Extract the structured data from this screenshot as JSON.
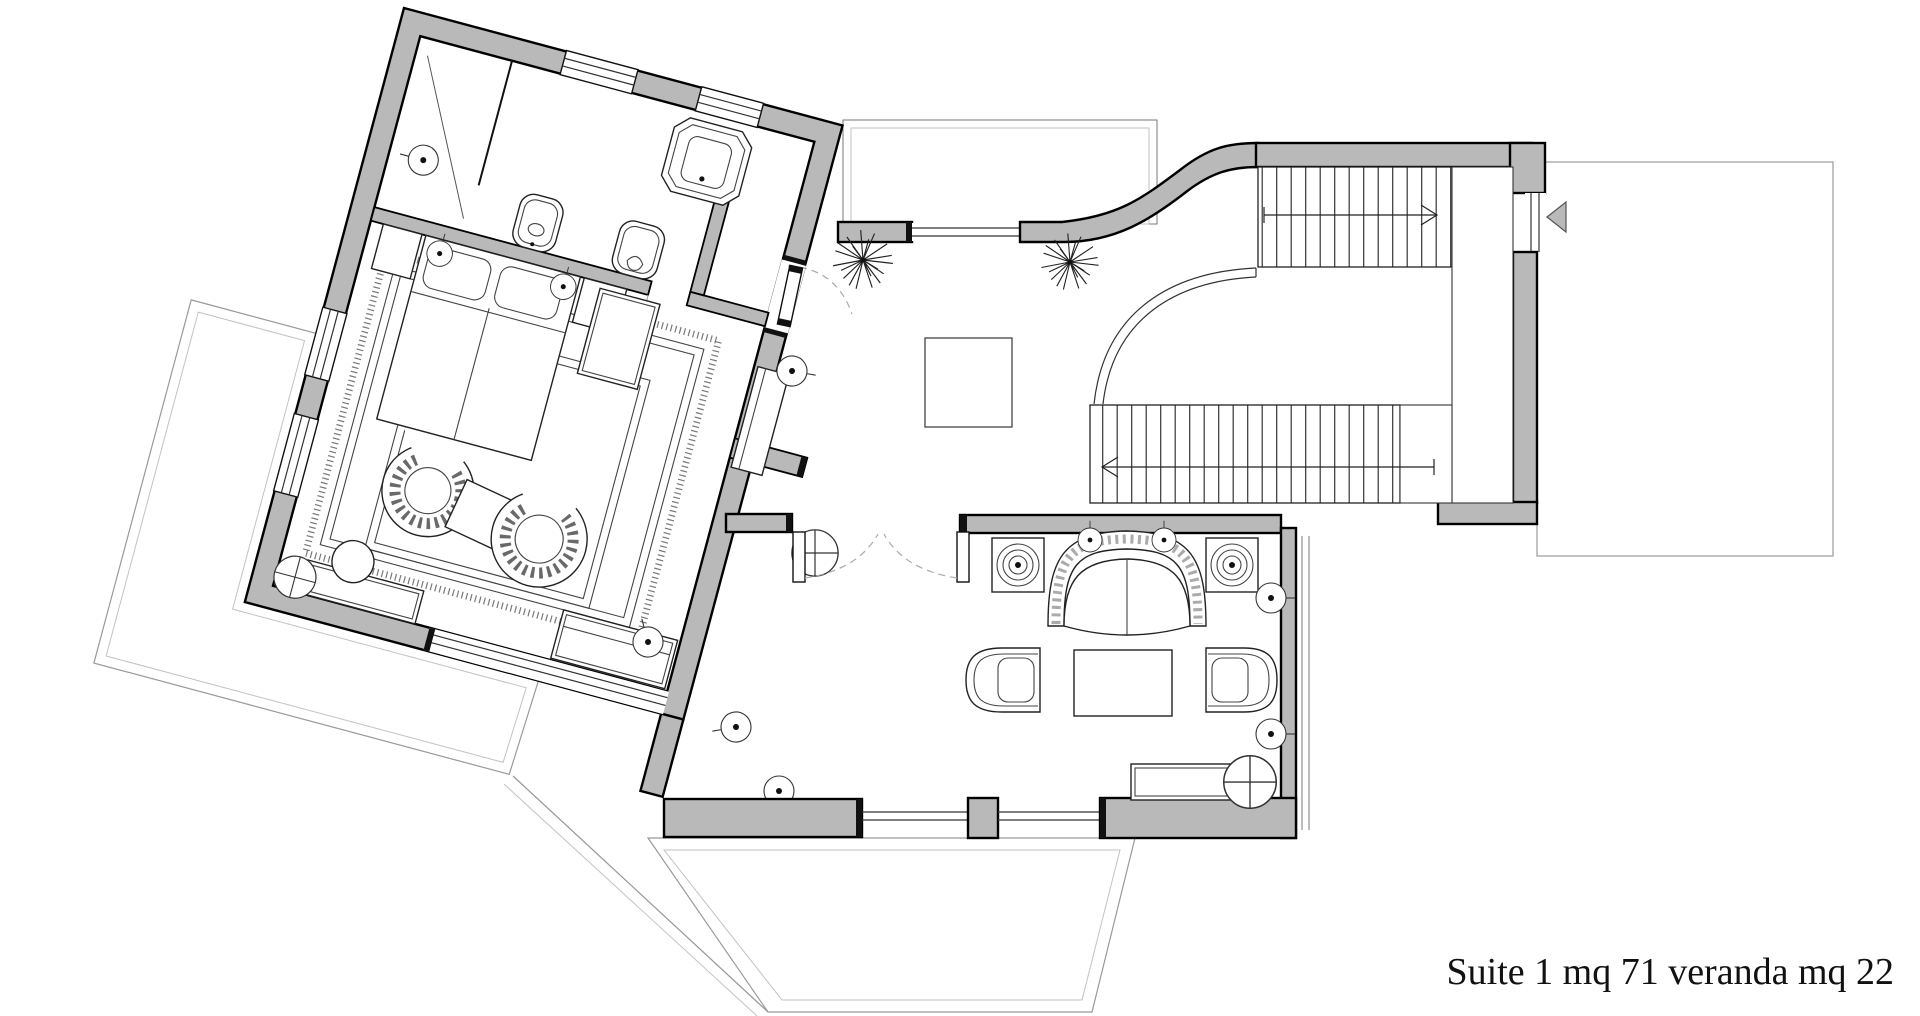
{
  "drawing": {
    "type": "architectural-floor-plan",
    "area_label": "Suite 1 mq 71 veranda mq 22"
  },
  "colors": {
    "background": "#ffffff",
    "wall_fill": "#b9b9b9",
    "wall_outline": "#000000",
    "thin_line": "#333333",
    "tile_line": "#cfcfcf",
    "dashed_line": "#aaaaaa"
  },
  "icons": {
    "stair_up_arrow": "right",
    "stair_down_arrow": "left",
    "terrace_entry_arrow": "left-triangle",
    "plant": "starburst",
    "ceiling_light": "circle-crosshair",
    "wall_lamp": "circle-with-dot"
  }
}
